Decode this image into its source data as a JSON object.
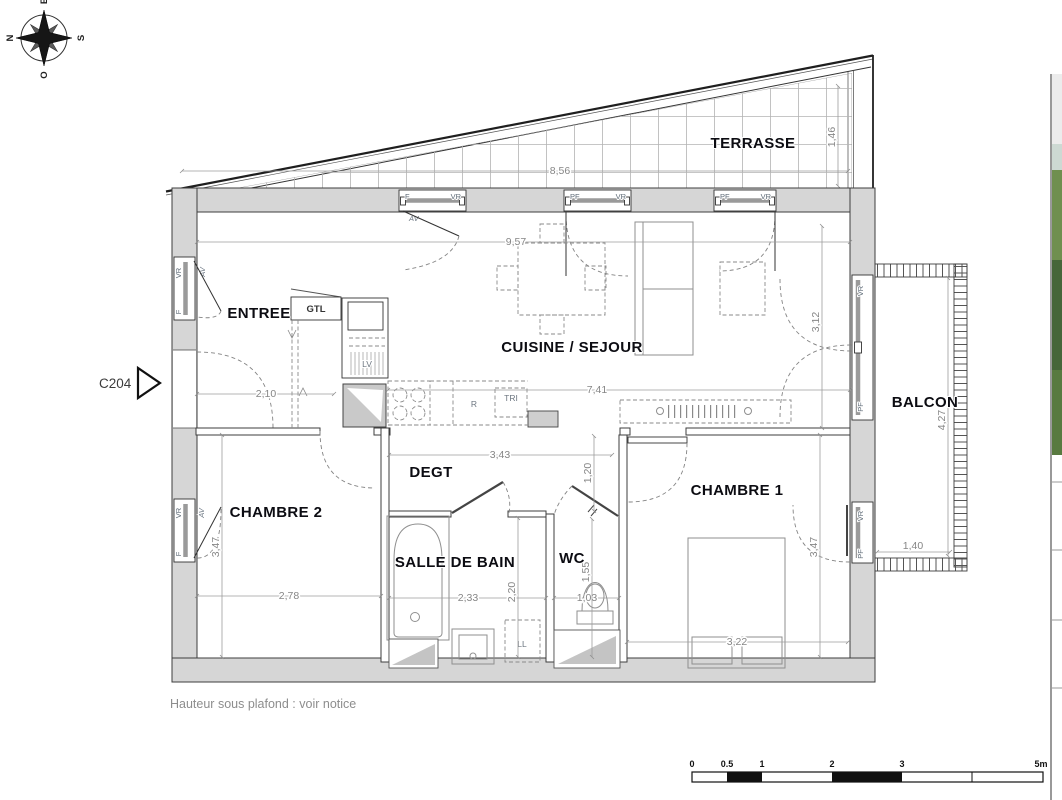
{
  "compass": {
    "n": "N",
    "e": "E",
    "s": "S",
    "o": "O"
  },
  "unit": {
    "code": "C204"
  },
  "rooms": {
    "terrasse": "TERRASSE",
    "entree": "ENTREE",
    "cuisine_sejour": "CUISINE / SEJOUR",
    "balcon": "BALCON",
    "chambre1": "CHAMBRE 1",
    "chambre2": "CHAMBRE 2",
    "degt": "DEGT",
    "salle_de_bain": "SALLE DE BAIN",
    "wc": "WC"
  },
  "equipment": {
    "gtl": "GTL",
    "lv": "LV",
    "fridge": "R",
    "tri": "TRI",
    "ll": "LL"
  },
  "opening_tags": {
    "f": "F",
    "vr": "VR",
    "pf": "PF",
    "av": "AV"
  },
  "dims": {
    "terrasse_width": "8,56",
    "terrasse_depth": "1,46",
    "sejour_top": "9,57",
    "entree_width": "2,10",
    "sejour_width": "7,41",
    "sejour_depth": "3,12",
    "degt_width": "3,43",
    "degt_depth": "1,20",
    "chambre2_depth": "3,47",
    "chambre2_width": "2,78",
    "sdb_width": "2,33",
    "sdb_depth": "2,20",
    "wc_width": "1,03",
    "wc_depth": "1,55",
    "chambre1_width": "3,22",
    "chambre1_depth": "3,47",
    "balcon_depth": "4,27",
    "balcon_width": "1,40"
  },
  "footer": {
    "ceiling_note": "Hauteur sous plafond : voir notice"
  },
  "scale_bar": {
    "labels": [
      "0",
      "0.5",
      "1",
      "2",
      "3",
      "5m"
    ]
  }
}
